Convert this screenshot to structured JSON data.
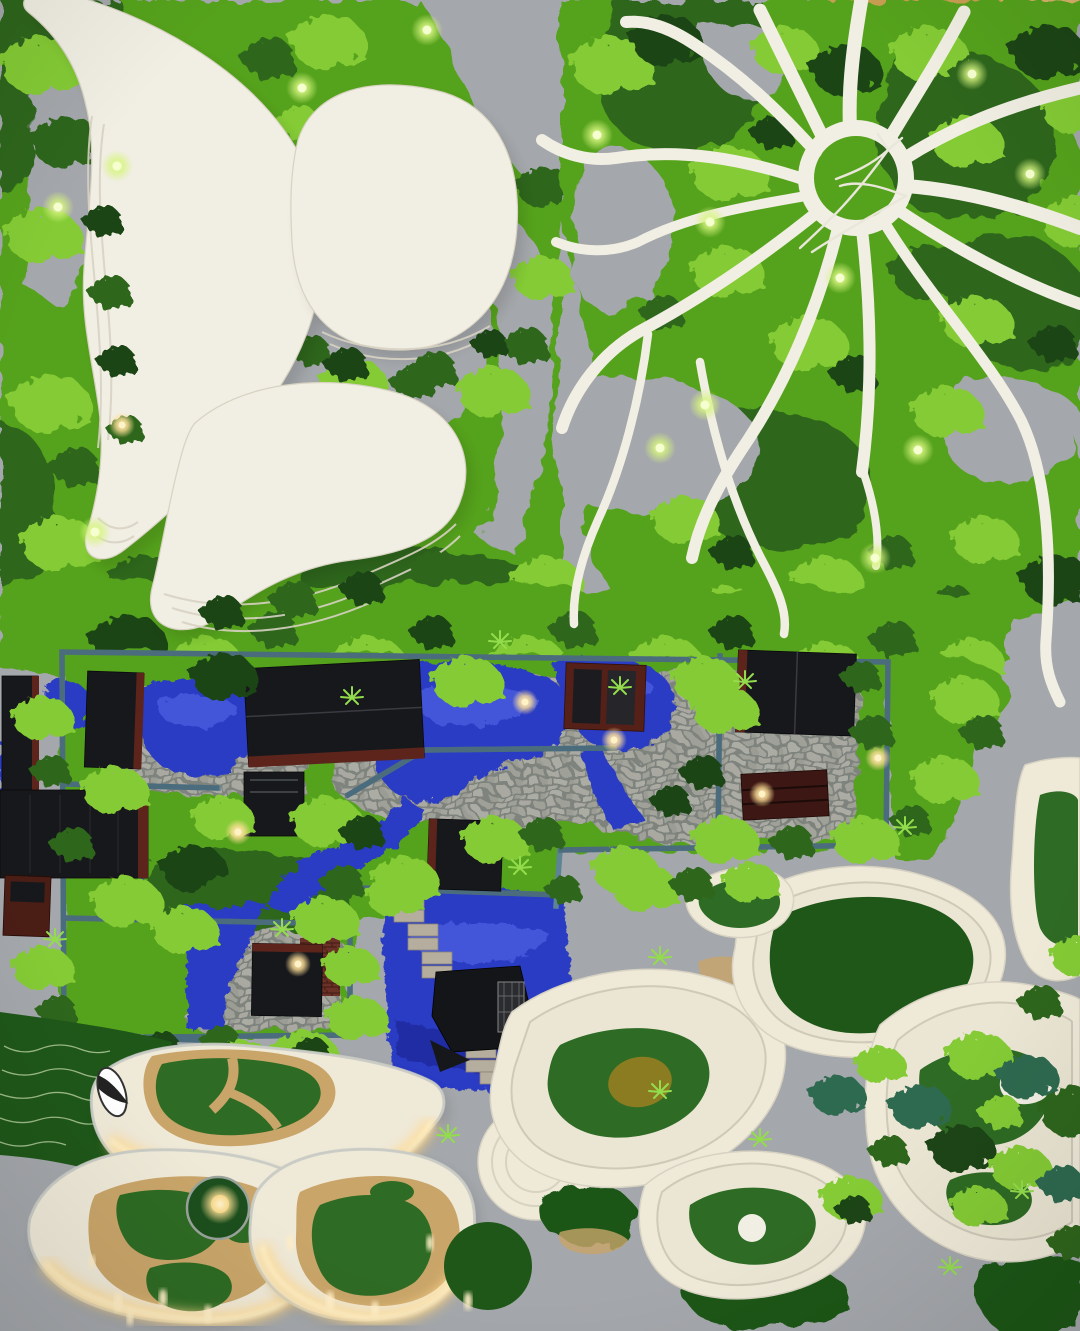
{
  "scene": {
    "subject": "Top-down photograph of a physical architecture landscape scale model",
    "regions": [
      {
        "name": "organic-white-towers",
        "desc": "Three white kidney and oval shaped buildings with stepped floor plates set in reindeer-moss landscape"
      },
      {
        "name": "radial-canopy",
        "desc": "White ring structure with curving branches radiating over moss, thin twig sculpture in the ring"
      },
      {
        "name": "walled-garden-compound",
        "desc": "Teal-walled courtyard garden with dark pavilions, maroon trim, cobblestone paths and royal-blue water"
      },
      {
        "name": "stepped-waterfall-pool",
        "desc": "Blue pool crossed by a zigzag stone stair with a dark pavilion"
      },
      {
        "name": "glossy-islands",
        "desc": "Three glossy resin islands with green lawn patches, sand trails and warm edge lighting, small round pond with gold light"
      },
      {
        "name": "terraced-hills",
        "desc": "White contour-terraced hills with dark green felt patches, olive patches and moss clumps"
      },
      {
        "name": "base-board",
        "desc": "Gray model base with wood strip at the top edge and scattered LED lights"
      }
    ]
  },
  "palette": {
    "base_gray": "#a4a7ab",
    "wood": "#c79e52",
    "wood_dark": "#a87f3a",
    "white_struct": "#f1eee3",
    "white_edge": "#d7d2c2",
    "moss_light": "#84cb35",
    "moss_mid": "#55a21e",
    "moss_dark": "#2f661b",
    "moss_deepest": "#1d4514",
    "moss_teal": "#2e6b4f",
    "plant_green": "#93dd4d",
    "water_blue": "#2c3bc4",
    "water_light": "#5d72ee",
    "water_dark": "#161e7d",
    "wall_teal": "#5e8394",
    "wall_teal_dark": "#3c5a68",
    "building_dark": "#17181c",
    "trim_maroon": "#5c241b",
    "brick_red": "#6b3026",
    "felt_green": "#2e6b24",
    "felt_dark": "#1f5719",
    "olive": "#8b7c22",
    "sand": "#c9a569",
    "cream": "#efe9d8",
    "glow_lime": "#e9ffa3",
    "glow_warm": "#ffdf96",
    "step_gray": "#b5ae9f",
    "silver": "#c9cbcb"
  }
}
